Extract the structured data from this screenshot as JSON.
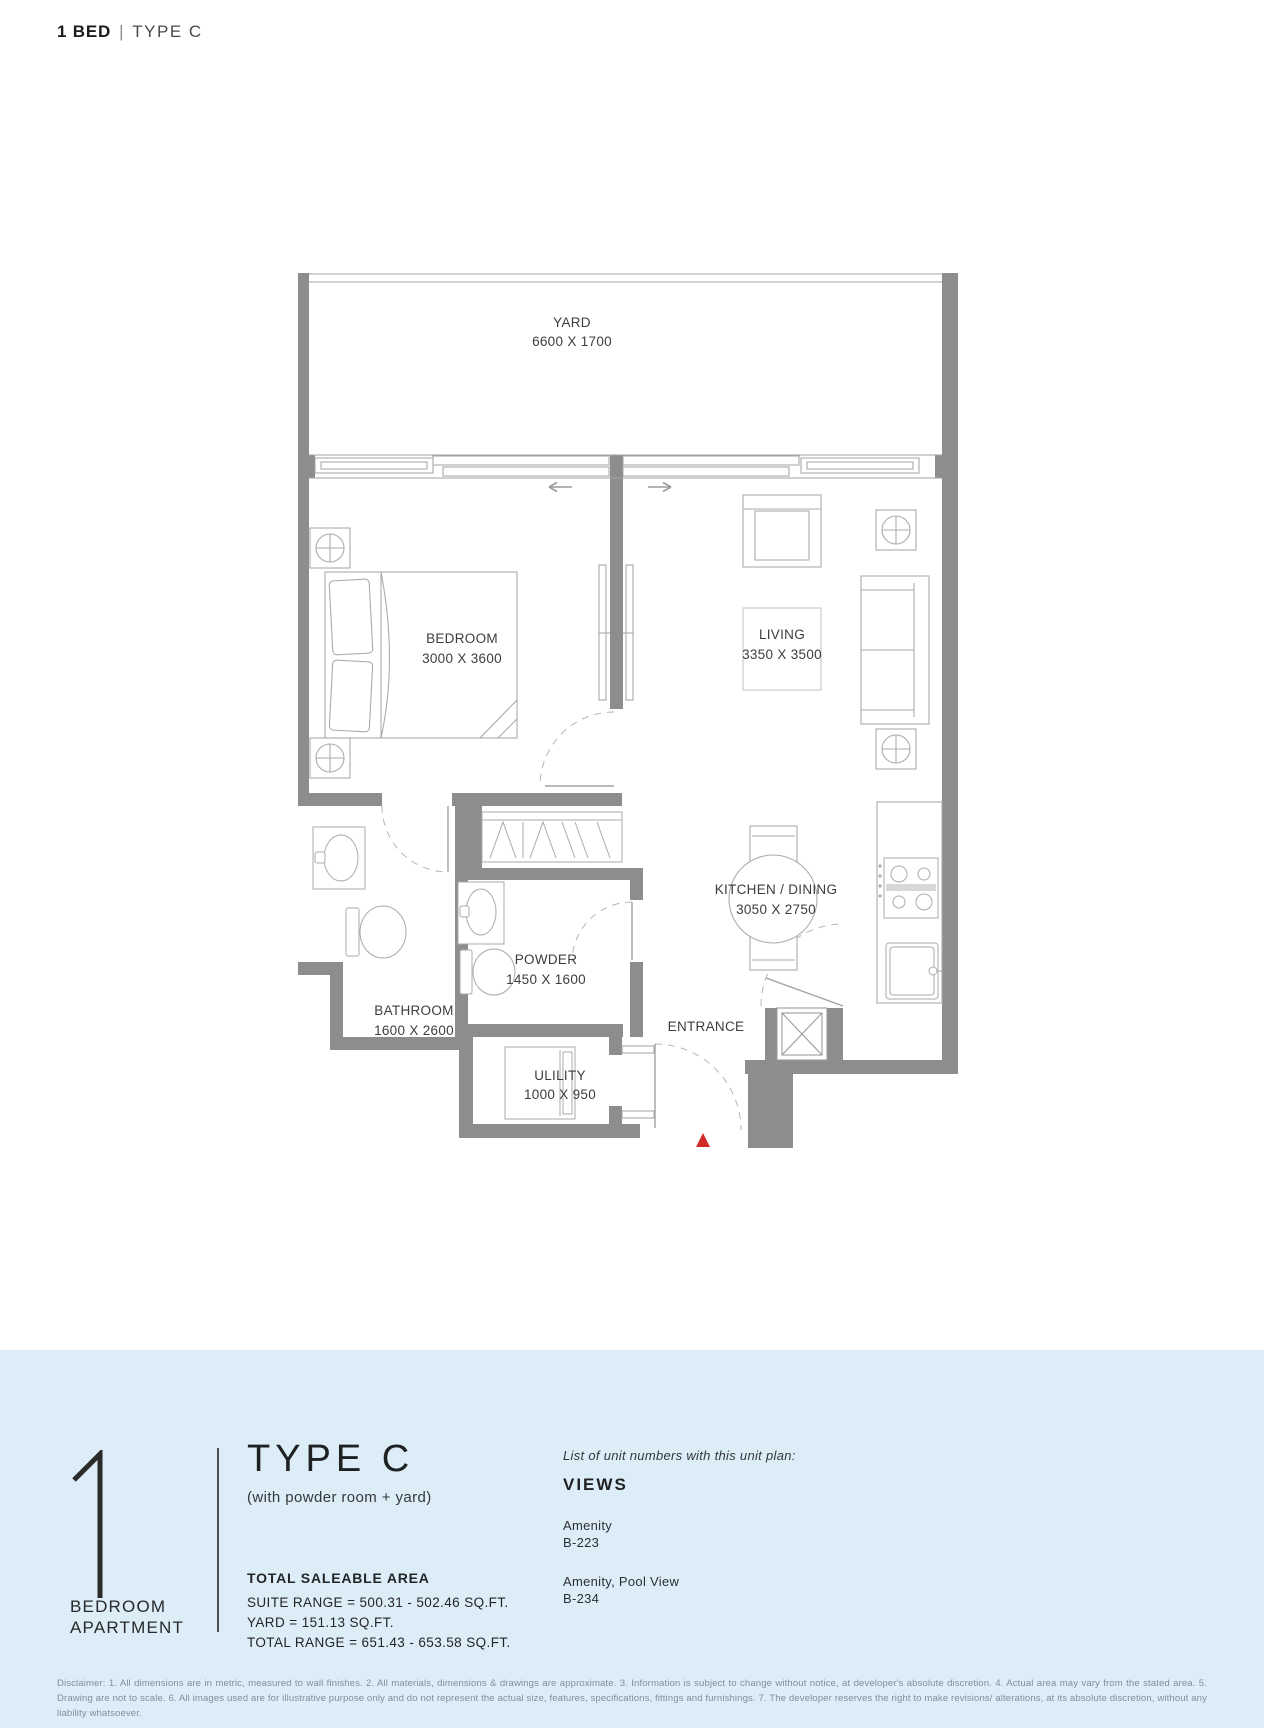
{
  "header": {
    "unit": "1 BED",
    "separator": "|",
    "type": "TYPE C"
  },
  "plan": {
    "rooms": {
      "yard": {
        "name": "YARD",
        "dims": "6600 X 1700"
      },
      "bedroom": {
        "name": "BEDROOM",
        "dims": "3000 X 3600"
      },
      "living": {
        "name": "LIVING",
        "dims": "3350 X 3500"
      },
      "kitchen": {
        "name": "KITCHEN / DINING",
        "dims": "3050 X 2750"
      },
      "bathroom": {
        "name": "BATHROOM",
        "dims": "1600 X 2600"
      },
      "powder": {
        "name": "POWDER",
        "dims": "1450 X 1600"
      },
      "utility": {
        "name": "ULILITY",
        "dims": "1000 X 950"
      }
    },
    "entrance_label": "ENTRANCE",
    "colors": {
      "wall": "#8d8d8d",
      "entrance_marker": "#d02b27"
    }
  },
  "info": {
    "unit_number": "1",
    "unit_label_line1": "BEDROOM",
    "unit_label_line2": "APARTMENT",
    "type_title": "TYPE C",
    "type_subtitle": "(with powder room + yard)",
    "area_heading": "TOTAL SALEABLE AREA",
    "area_lines": [
      "SUITE RANGE = 500.31 - 502.46 SQ.FT.",
      "YARD = 151.13 SQ.FT.",
      "TOTAL RANGE = 651.43 - 653.58 SQ.FT."
    ],
    "views_intro": "List of unit numbers with this unit plan:",
    "views_heading": "VIEWS",
    "views": [
      {
        "view": "Amenity",
        "unit": "B-223"
      },
      {
        "view": "Amenity, Pool View",
        "unit": "B-234"
      }
    ]
  },
  "disclaimer": "Disclaimer: 1. All dimensions are in metric, measured to wall finishes. 2. All materials, dimensions & drawings are approximate. 3. Information is subject to change without notice, at developer's absolute discretion. 4. Actual area may vary from the stated area. 5. Drawing are not to scale. 6. All images used are for illustrative purpose only and do not represent the actual size, features, specifications, fittings and furnishings. 7. The developer reserves the right to make revisions/ alterations, at its absolute discretion, without any liability whatsoever."
}
